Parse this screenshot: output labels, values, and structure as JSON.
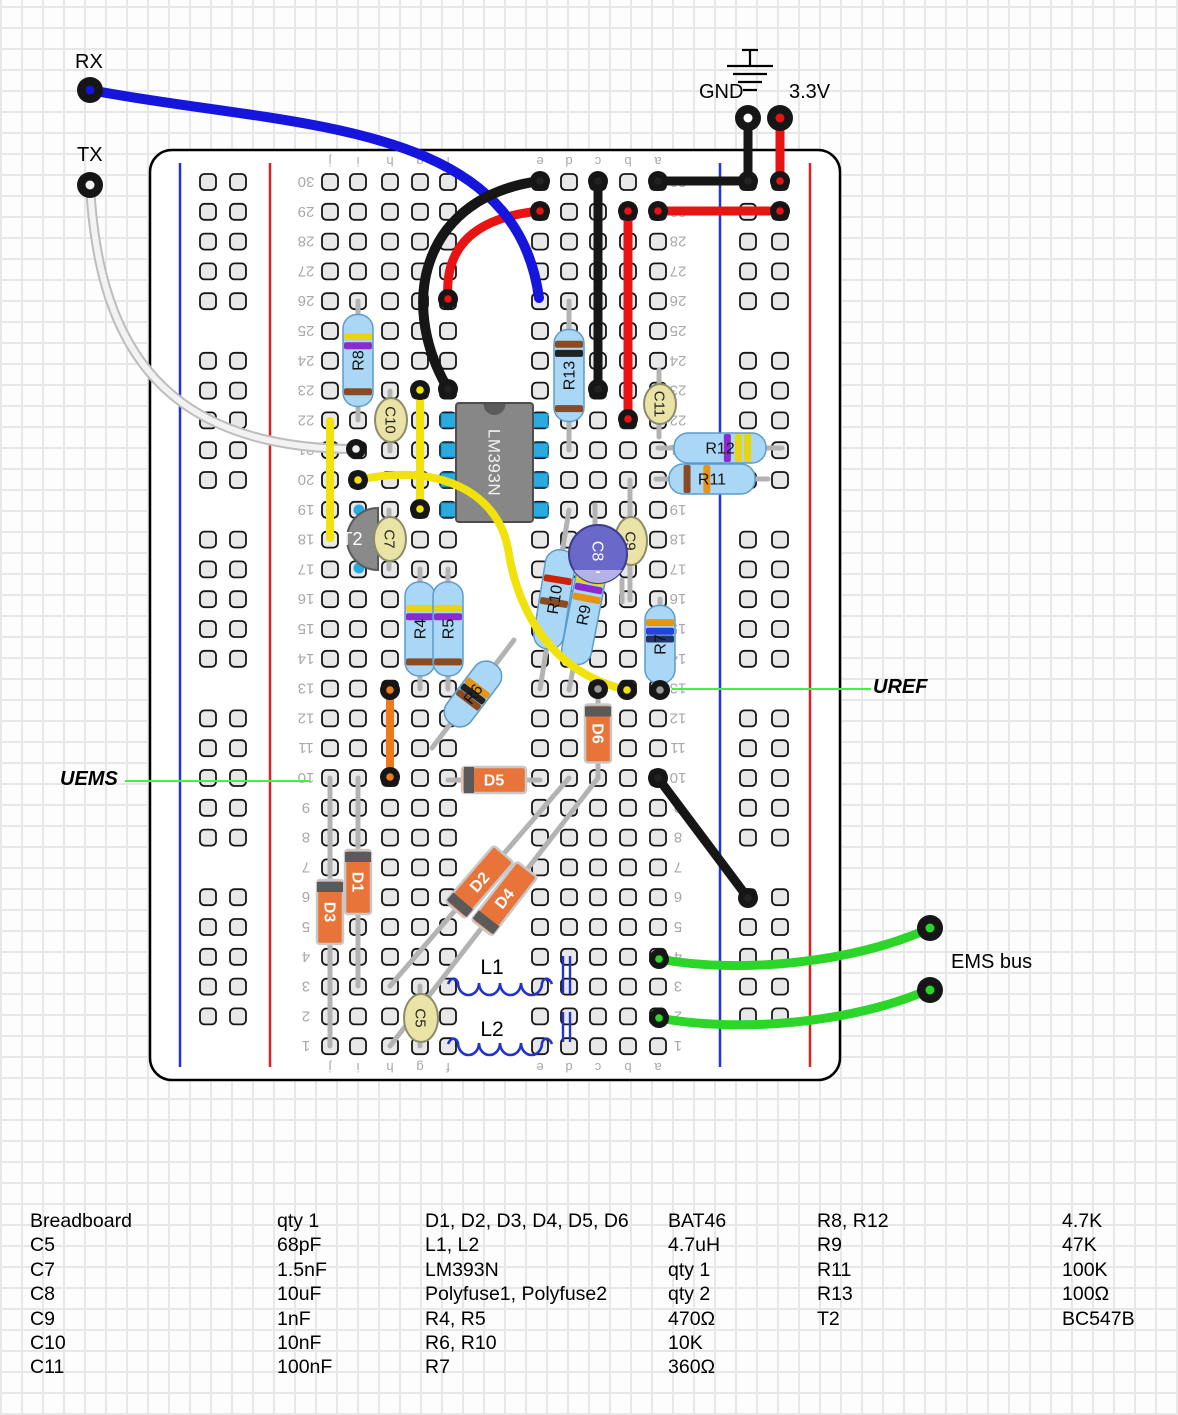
{
  "annotations": {
    "rx": "RX",
    "tx": "TX",
    "gnd": "GND",
    "v33": "3.3V",
    "ems_bus": "EMS bus",
    "uref": "UREF",
    "uems": "UEMS"
  },
  "board": {
    "x": 150,
    "y": 150,
    "w": 690,
    "h": 930,
    "corner": 22,
    "rows": 30,
    "row_top": 182,
    "pitch": 29.8,
    "main_cols": {
      "j": 330,
      "i": 358,
      "h": 390,
      "g": 420,
      "f": 448,
      "e": 540,
      "d": 569,
      "c": 598,
      "b": 628,
      "a": 658
    },
    "letters": [
      "j",
      "i",
      "h",
      "g",
      "f",
      "e",
      "d",
      "c",
      "b",
      "a"
    ],
    "letter_rows_y": [
      161,
      1067
    ],
    "number_cols_x": [
      306,
      678
    ],
    "rail_left": {
      "blue_x": 180,
      "red_x": 270,
      "holes_x": [
        208,
        238
      ]
    },
    "rail_right": {
      "blue_x": 720,
      "red_x": 810,
      "holes_x": [
        748,
        780
      ]
    },
    "rail_row_groups": [
      [
        30,
        26
      ],
      [
        24,
        20
      ],
      [
        18,
        14
      ],
      [
        12,
        8
      ],
      [
        6,
        2
      ]
    ],
    "rail_line_y1": 163,
    "rail_line_y2": 1067
  },
  "colors": {
    "hole_fill": "#e8e8e8",
    "hole_stroke": "#161616",
    "resistor_body": "#a9d7f5",
    "resistor_stroke": "#5d9bc9",
    "ceramic_fill": "#eae3a6",
    "ceramic_stroke": "#8c8c6a",
    "electro_fill": "#6a68c8",
    "electro_stripe": "#b4b2e4",
    "electro_stroke": "#3c3c8c",
    "diode_fill": "#e8743a",
    "diode_stroke": "#c8c8c8",
    "diode_band": "#5a5a5a",
    "lead": "#b3b3b3",
    "ic_fill": "#878787",
    "ic_stroke": "#4d4d4d",
    "ic_pin": "#29abe2",
    "transistor_fill": "#8a8a8a",
    "inductor": "#2233cc",
    "pointer_green": "#3cf53c",
    "label_gray": "#a8a8a8"
  },
  "terminals": [
    {
      "name": "rx-terminal",
      "x": 90,
      "y": 90,
      "core": "#1515dd"
    },
    {
      "name": "tx-terminal",
      "x": 90,
      "y": 185,
      "core": "#f2f2f2"
    },
    {
      "name": "gnd-terminal",
      "x": 748,
      "y": 118,
      "core": "#ffffff"
    },
    {
      "name": "v33-terminal",
      "x": 780,
      "y": 118,
      "core": "#e81414"
    },
    {
      "name": "ems-terminal-1",
      "x": 930,
      "y": 928,
      "core": "#2bd629"
    },
    {
      "name": "ems-terminal-2",
      "x": 930,
      "y": 990,
      "core": "#2bd629"
    }
  ],
  "wires": [
    {
      "name": "wire-gnd-drop",
      "color": "#161616",
      "w": 9,
      "path": "M748,118 L748,181"
    },
    {
      "name": "wire-v33-drop",
      "color": "#e81414",
      "w": 9,
      "path": "M780,118 L780,181"
    },
    {
      "name": "wire-black-row30",
      "color": "#161616",
      "w": 9,
      "path": "M658,181 L748,181"
    },
    {
      "name": "wire-red-row29",
      "color": "#e81414",
      "w": 9,
      "path": "M658,211 L780,211"
    },
    {
      "name": "wire-red-arc",
      "color": "#e81414",
      "w": 9,
      "path": "M540,211 C478,217 444,244 448,299"
    },
    {
      "name": "wire-rx-blue",
      "color": "#1515dd",
      "w": 10,
      "path": "M90,90 C290,128 515,118 539,298"
    },
    {
      "name": "wire-black-arc",
      "color": "#161616",
      "w": 10,
      "path": "M540,181 C425,196 396,300 448,389"
    },
    {
      "name": "wire-black-c",
      "color": "#161616",
      "w": 9,
      "path": "M598,181 L598,389"
    },
    {
      "name": "wire-red-b",
      "color": "#e81414",
      "w": 9,
      "path": "M628,211 L628,419"
    },
    {
      "name": "wire-tx-white",
      "color": "#f2f2f2",
      "outline": "#bdbdbd",
      "w": 6,
      "ow": 10,
      "path": "M90,185 C98,330 150,449 356,449"
    },
    {
      "name": "wire-yellow-j",
      "color": "#f0e20a",
      "w": 8,
      "path": "M330,421 L330,538"
    },
    {
      "name": "wire-yellow-g",
      "color": "#f0e20a",
      "w": 8,
      "path": "M420,390 L420,509"
    },
    {
      "name": "wire-yellow-long",
      "color": "#f0e20a",
      "w": 8,
      "path": "M358,480 C445,461 499,497 508,549 C517,607 548,672 627,690"
    },
    {
      "name": "wire-orange-h",
      "color": "#ef7a1a",
      "w": 8,
      "path": "M390,690 L390,777"
    },
    {
      "name": "wire-black-diag",
      "color": "#161616",
      "w": 9,
      "path": "M658,778 L748,898"
    },
    {
      "name": "wire-green-1",
      "color": "#2bd629",
      "w": 9,
      "path": "M659,959 C740,974 852,963 928,929"
    },
    {
      "name": "wire-green-2",
      "color": "#2bd629",
      "w": 9,
      "path": "M659,1018 C740,1033 852,1023 928,990"
    }
  ],
  "rings": [
    [
      540,
      181,
      "#222"
    ],
    [
      598,
      181,
      "#222"
    ],
    [
      658,
      181,
      "#222"
    ],
    [
      748,
      181,
      "#222"
    ],
    [
      540,
      211,
      "#e81414"
    ],
    [
      658,
      211,
      "#e81414"
    ],
    [
      780,
      181,
      "#e81414"
    ],
    [
      780,
      211,
      "#e81414"
    ],
    [
      628,
      211,
      "#e81414"
    ],
    [
      628,
      419,
      "#e81414"
    ],
    [
      598,
      389,
      "#222"
    ],
    [
      448,
      299,
      "#e81414"
    ],
    [
      448,
      389,
      "#222"
    ],
    [
      356,
      449,
      "#eeeeee"
    ],
    [
      358,
      480,
      "#f0e20a"
    ],
    [
      420,
      390,
      "#f0e20a"
    ],
    [
      420,
      509,
      "#f0e20a"
    ],
    [
      627,
      690,
      "#f0e20a"
    ],
    [
      598,
      689,
      "#999"
    ],
    [
      660,
      690,
      "#999"
    ],
    [
      390,
      690,
      "#ef7a1a"
    ],
    [
      390,
      777,
      "#ef7a1a"
    ],
    [
      658,
      778,
      "#222"
    ],
    [
      748,
      898,
      "#222"
    ],
    [
      659,
      959,
      "#2bd629"
    ],
    [
      659,
      1018,
      "#2bd629"
    ]
  ],
  "resistors": [
    {
      "label": "R8",
      "x1": 358,
      "y1": 301,
      "x2": 358,
      "y2": 420,
      "body": 92,
      "bands": [
        [
          0.24,
          "#e8d50f"
        ],
        [
          0.34,
          "#8a2bd0"
        ],
        [
          0.84,
          "#8a4b22"
        ]
      ],
      "lrot": -90,
      "conn": "i26-i22"
    },
    {
      "label": "R13",
      "x1": 569,
      "y1": 301,
      "x2": 569,
      "y2": 450,
      "body": 92,
      "bands": [
        [
          0.16,
          "#8a4b22"
        ],
        [
          0.26,
          "#222222"
        ],
        [
          0.86,
          "#8a4b22"
        ]
      ],
      "lrot": -90,
      "conn": "d26-d21"
    },
    {
      "label": "R12",
      "x1": 658,
      "y1": 448,
      "x2": 782,
      "y2": 448,
      "body": 92,
      "bands": [
        [
          0.58,
          "#8a2bd0"
        ],
        [
          0.7,
          "#e8d50f"
        ],
        [
          0.8,
          "#e8d50f"
        ]
      ],
      "lrot": 0,
      "conn": "a21-3.3V-rail"
    },
    {
      "label": "R11",
      "x1": 656,
      "y1": 479,
      "x2": 768,
      "y2": 479,
      "body": 86,
      "bands": [
        [
          0.21,
          "#8a4b22"
        ],
        [
          0.44,
          "#e8940f"
        ]
      ],
      "lrot": 0,
      "conn": "a20-rail"
    },
    {
      "label": "R4",
      "x1": 420,
      "y1": 569,
      "x2": 420,
      "y2": 689,
      "body": 94,
      "bands": [
        [
          0.28,
          "#e8d50f"
        ],
        [
          0.37,
          "#8a2bd0"
        ],
        [
          0.85,
          "#8a4b22"
        ]
      ],
      "lrot": -90,
      "conn": "g17-g13"
    },
    {
      "label": "R5",
      "x1": 448,
      "y1": 569,
      "x2": 448,
      "y2": 689,
      "body": 94,
      "bands": [
        [
          0.28,
          "#e8d50f"
        ],
        [
          0.37,
          "#8a2bd0"
        ],
        [
          0.85,
          "#8a4b22"
        ]
      ],
      "lrot": -90,
      "conn": "f17-f13"
    },
    {
      "label": "R6",
      "x1": 432,
      "y1": 748,
      "x2": 514,
      "y2": 640,
      "body": 74,
      "bands": [
        [
          0.4,
          "#8a4b22"
        ],
        [
          0.5,
          "#222222"
        ],
        [
          0.6,
          "#e8940f"
        ]
      ],
      "lrot": -53,
      "conn": "g11-e15"
    },
    {
      "label": "R10",
      "x1": 569,
      "y1": 510,
      "x2": 540,
      "y2": 689,
      "body": 100,
      "bands": [
        [
          0.3,
          "#cc2200"
        ],
        [
          0.53,
          "#8a4b22"
        ]
      ],
      "lrot": -81,
      "conn": "d19-e13"
    },
    {
      "label": "R9",
      "x1": 598,
      "y1": 540,
      "x2": 569,
      "y2": 690,
      "body": 100,
      "bands": [
        [
          0.15,
          "#e8d50f"
        ],
        [
          0.23,
          "#8a2bd0"
        ],
        [
          0.33,
          "#e8940f"
        ]
      ],
      "lrot": -79,
      "conn": "c18-d13"
    },
    {
      "label": "R7",
      "x1": 660,
      "y1": 599,
      "x2": 660,
      "y2": 690,
      "body": 78,
      "bands": [
        [
          0.22,
          "#e8940f"
        ],
        [
          0.33,
          "#2244dd"
        ],
        [
          0.43,
          "#223366"
        ]
      ],
      "lrot": -90,
      "conn": "a16-a13"
    }
  ],
  "diodes": [
    {
      "label": "D1",
      "x1": 358,
      "y1": 778,
      "x2": 358,
      "y2": 986,
      "body": 64,
      "bt": 0.5,
      "lrot": 90,
      "conn": "i10-i3"
    },
    {
      "label": "D2",
      "x1": 390,
      "y1": 986,
      "x2": 569,
      "y2": 778,
      "body": 74,
      "bt": 0.5,
      "lrot": -49,
      "conn": "h3-d10"
    },
    {
      "label": "D3",
      "x1": 330,
      "y1": 778,
      "x2": 330,
      "y2": 1046,
      "body": 64,
      "bt": 0.5,
      "lrot": 90,
      "conn": "j10-j1"
    },
    {
      "label": "D4",
      "x1": 390,
      "y1": 1046,
      "x2": 598,
      "y2": 778,
      "body": 74,
      "bt": 0.55,
      "lrot": -52,
      "conn": "h1-c10"
    },
    {
      "label": "D5",
      "x1": 448,
      "y1": 780,
      "x2": 540,
      "y2": 780,
      "body": 64,
      "bt": 0.5,
      "lrot": 0,
      "conn": "f10-e10"
    },
    {
      "label": "D6",
      "x1": 598,
      "y1": 689,
      "x2": 598,
      "y2": 778,
      "body": 58,
      "bt": 0.5,
      "lrot": 90,
      "conn": "c13-c10"
    }
  ],
  "ceramic_caps": [
    {
      "label": "C5",
      "x": 420,
      "yl1": 986,
      "yl2": 1046,
      "cx": 421,
      "cy": 1018,
      "rx": 17,
      "ry": 24,
      "conn": "g3-g1"
    },
    {
      "label": "C7",
      "x": 389,
      "yl1": 510,
      "yl2": 569,
      "cx": 390,
      "cy": 539,
      "rx": 16,
      "ry": 22,
      "conn": "h19-h17"
    },
    {
      "label": "C9",
      "x": 630,
      "yl1": 480,
      "yl2": 600,
      "cx": 631,
      "cy": 541,
      "rx": 16,
      "ry": 24,
      "conn": "b20-b16"
    },
    {
      "label": "C10",
      "x": 390,
      "yl1": 391,
      "yl2": 451,
      "cx": 391,
      "cy": 420,
      "rx": 16,
      "ry": 22,
      "conn": "h23-h21"
    },
    {
      "label": "C11",
      "x": 659,
      "yl1": 370,
      "yl2": 437,
      "cx": 660,
      "cy": 404,
      "rx": 16,
      "ry": 20,
      "conn": "a24-a22"
    }
  ],
  "electro_cap": {
    "label": "C8",
    "minus": "-",
    "cx": 598,
    "cy": 554,
    "r": 29,
    "legs": [
      [
        595,
        505,
        595,
        530
      ],
      [
        622,
        580,
        622,
        602
      ]
    ],
    "conn": "c19-c17"
  },
  "ic": {
    "label": "LM393N",
    "x": 456,
    "y": 403,
    "w": 77,
    "h": 119,
    "pin_rows": [
      19,
      20,
      21,
      22
    ],
    "left_pin_x": 441,
    "right_pin_x": 532
  },
  "transistor": {
    "label": "T2",
    "cx": 378,
    "cy": 539,
    "r": 31,
    "pins": [
      [
        359,
        510
      ],
      [
        359,
        568
      ]
    ],
    "conn": "i19-i17"
  },
  "inductors": [
    {
      "label": "L1",
      "y": 986,
      "x1": 448,
      "x2": 540,
      "core_x": [
        563,
        570
      ],
      "cy1": 956,
      "cy2": 994,
      "lx": 492,
      "ly": 967,
      "conn": "f3-e3"
    },
    {
      "label": "L2",
      "y": 1046,
      "x1": 448,
      "x2": 540,
      "core_x": [
        563,
        570
      ],
      "cy1": 1012,
      "cy2": 1042,
      "lx": 492,
      "ly": 1029,
      "conn": "f1-e1"
    }
  ],
  "gnd_symbol": {
    "x": 750,
    "stem_y1": 50,
    "stem_y2": 66,
    "bars": [
      [
        66,
        46
      ],
      [
        74,
        34
      ],
      [
        82,
        24
      ],
      [
        90,
        14
      ]
    ]
  },
  "pointer_lines": [
    {
      "name": "uems-pointer",
      "x1": 125,
      "y1": 781,
      "x2": 310,
      "y2": 781
    },
    {
      "name": "uref-pointer",
      "x1": 672,
      "y1": 689,
      "x2": 871,
      "y2": 689
    }
  ],
  "parts_list": {
    "top": 1210,
    "line_h": 24.4,
    "pairs": [
      {
        "name_x": 30,
        "value_x": 277,
        "rows": [
          {
            "name": "Breadboard",
            "value": "qty 1"
          },
          {
            "name": "C5",
            "value": "68pF"
          },
          {
            "name": "C7",
            "value": "1.5nF"
          },
          {
            "name": "C8",
            "value": "10uF"
          },
          {
            "name": "C9",
            "value": "1nF"
          },
          {
            "name": "C10",
            "value": "10nF"
          },
          {
            "name": "C11",
            "value": "100nF"
          }
        ]
      },
      {
        "name_x": 425,
        "value_x": 668,
        "rows": [
          {
            "name": "D1, D2, D3, D4, D5, D6",
            "value": "BAT46"
          },
          {
            "name": "L1, L2",
            "value": "4.7uH"
          },
          {
            "name": "LM393N",
            "value": "qty 1"
          },
          {
            "name": "Polyfuse1, Polyfuse2",
            "value": "qty 2"
          },
          {
            "name": "R4, R5",
            "value": "470Ω"
          },
          {
            "name": "R6, R10",
            "value": "10K"
          },
          {
            "name": "R7",
            "value": "360Ω"
          }
        ]
      },
      {
        "name_x": 817,
        "value_x": 1062,
        "rows": [
          {
            "name": "R8, R12",
            "value": "4.7K"
          },
          {
            "name": "R9",
            "value": "47K"
          },
          {
            "name": "R11",
            "value": "100K"
          },
          {
            "name": "R13",
            "value": "100Ω"
          },
          {
            "name": "T2",
            "value": "BC547B"
          }
        ]
      }
    ]
  }
}
